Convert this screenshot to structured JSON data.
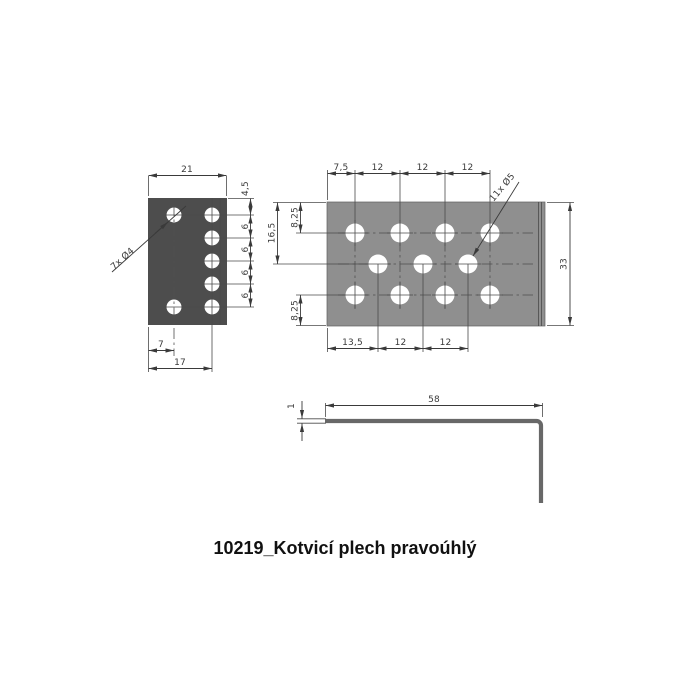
{
  "title": "10219_Kotvicí plech pravoúhlý",
  "colors": {
    "flange_fill": "#4d4d4d",
    "plate_fill": "#8f8f8f",
    "profile_stroke": "#686868",
    "dim_line": "#3a3a3a"
  },
  "flange_view": {
    "width_dim": "21",
    "hole_label": "7x Ø4",
    "right_dims": [
      "4,5",
      "6",
      "6",
      "6",
      "6"
    ],
    "offset_dim": "7",
    "span_dim": "17"
  },
  "plate_view": {
    "top_dims": [
      "7,5",
      "12",
      "12",
      "12"
    ],
    "left_outer_dim": "16,5",
    "left_top_dim": "8,25",
    "left_bottom_dim": "8,25",
    "height_dim": "33",
    "bottom_dims": [
      "13,5",
      "12",
      "12"
    ],
    "hole_label": "11x Ø5"
  },
  "profile_view": {
    "length_dim": "58",
    "thickness_dim": "1"
  }
}
